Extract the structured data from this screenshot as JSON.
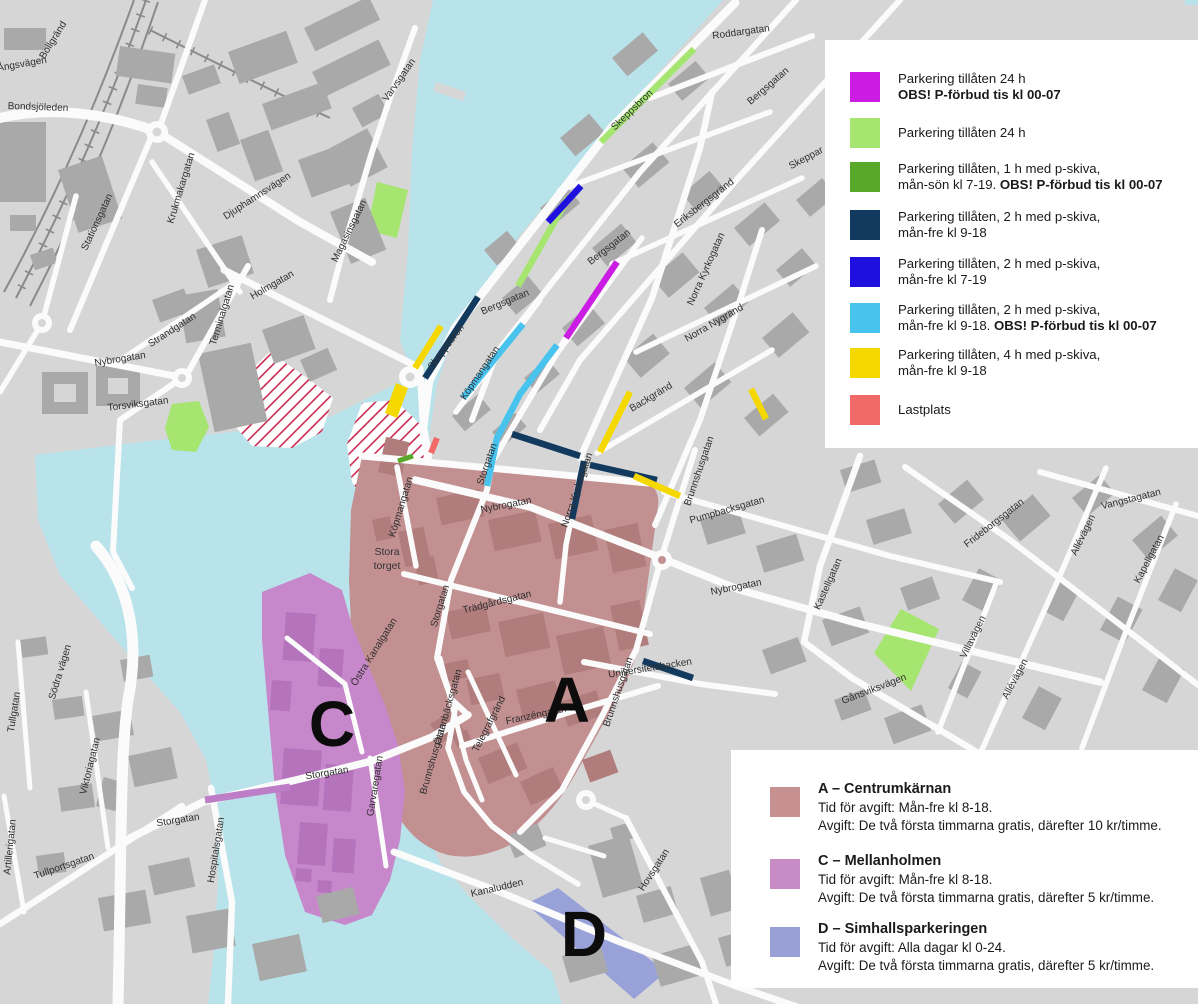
{
  "map": {
    "colors": {
      "water": "#b9e3ea",
      "land": "#d6d6d6",
      "road": "#fbfbfb",
      "building": "#a9a9a9",
      "rail": "#8a8a8a",
      "hatch_red": "#c92b52",
      "zone_a": "#c29091",
      "zone_a_building": "#b17c7c",
      "zone_c": "#c687cb",
      "zone_c_building": "#b573bb",
      "zone_d": "#99a2d8",
      "zone_c_line": "#bd7ec7",
      "p24_forbud": "#cb1ce4",
      "p24": "#a5e570",
      "p1h": "#58a82a",
      "p2h_navy": "#123a5f",
      "p2h_blue": "#1f10e0",
      "p2h_cyan": "#48c3ee",
      "p4h": "#f5d800",
      "lastplats": "#f26a68"
    },
    "street_labels": [
      "Bollgränd",
      "Ångsvägen",
      "Bondsjöleden",
      "Stationsgatan",
      "Krukmakargatan",
      "Djuphamnsvägen",
      "Holmgatan",
      "Strandgatan",
      "Terminalgatan",
      "Nybrogatan",
      "Torsviksgatan",
      "Varvsgatan",
      "Magasinsgatan",
      "Roddargatan",
      "Skeppsbron",
      "Bergsgatan",
      "Skeppar",
      "Eriksbergsgränd",
      "Bergsgatan",
      "Norra Kyrkogatan",
      "Norra Nygränd",
      "Skeppsbron",
      "Bergsgatan",
      "Köpmangatan",
      "Storgatan",
      "Backgränd",
      "Nybrogatan",
      "Norra Kyrkogatan",
      "Brunnshusgatan",
      "Pumpbacksgatan",
      "Nybrogatan",
      "Kastellgatan",
      "Frideborgsgatan",
      "Vangstagatan",
      "Allévägen",
      "Kapellgatan",
      "Villavägen",
      "Allévägen",
      "Gånsviksvägen",
      "Universitetsbacken",
      "Köpmangatan",
      "Storgatan",
      "Trädgårdsgatan",
      "Östra Kanalgatan",
      "Östanbäcksgatan",
      "Telegrafgränd",
      "Franzéngatan",
      "Brunnshusgatan",
      "Brunnshusgatan",
      "Storgatan",
      "Garvaregatan",
      "Södra vägen",
      "Tullgatan",
      "Viktoriagatan",
      "Artillerigatan",
      "Tullportsgatan",
      "Storgatan",
      "Hospitalsgatan",
      "Kanaludden",
      "Hovsgatan"
    ],
    "plaza": {
      "line1": "Stora",
      "line2": "torget"
    },
    "zone_letters": {
      "a": "A",
      "c": "C",
      "d": "D"
    }
  },
  "legend_parking": {
    "items": [
      {
        "color": "#cb1ce4",
        "line1": "Parkering tillåten 24 h",
        "line2_bold": "OBS! P-förbud tis kl 00-07"
      },
      {
        "color": "#a5e570",
        "line1": "Parkering tillåten 24 h"
      },
      {
        "color": "#58a82a",
        "line1": "Parkering tillåten, 1 h med p-skiva,",
        "line2": "mån-sön kl 7-19. ",
        "line2_bold": "OBS! P-förbud tis kl 00-07"
      },
      {
        "color": "#123a5f",
        "line1": "Parkering tillåten, 2 h med p-skiva,",
        "line2": "mån-fre kl 9-18"
      },
      {
        "color": "#1f10e0",
        "line1": "Parkering tillåten, 2 h med p-skiva,",
        "line2": "mån-fre kl 7-19"
      },
      {
        "color": "#48c3ee",
        "line1": "Parkering tillåten, 2 h med p-skiva,",
        "line2": "mån-fre kl 9-18. ",
        "line2_bold": "OBS! P-förbud tis kl 00-07"
      },
      {
        "color": "#f5d800",
        "line1": "Parkering tillåten, 4 h med p-skiva,",
        "line2": "mån-fre kl 9-18"
      },
      {
        "color": "#f26a68",
        "line1": "Lastplats"
      }
    ]
  },
  "legend_zones": {
    "items": [
      {
        "color": "#c79091",
        "title": "A – Centrumkärnan",
        "time": "Tid för avgift: Mån-fre kl 8-18.",
        "fee": "Avgift: De två första timmarna gratis, därefter 10 kr/timme."
      },
      {
        "color": "#c78bc5",
        "title": "C – Mellanholmen",
        "time": "Tid för avgift: Mån-fre kl 8-18.",
        "fee": "Avgift: De två första timmarna gratis, därefter 5 kr/timme."
      },
      {
        "color": "#98a0d6",
        "title": "D – Simhallsparkeringen",
        "time": "Tid för avgift: Alla dagar kl 0-24.",
        "fee": "Avgift: De två första timmarna gratis, därefter 5 kr/timme."
      }
    ]
  }
}
